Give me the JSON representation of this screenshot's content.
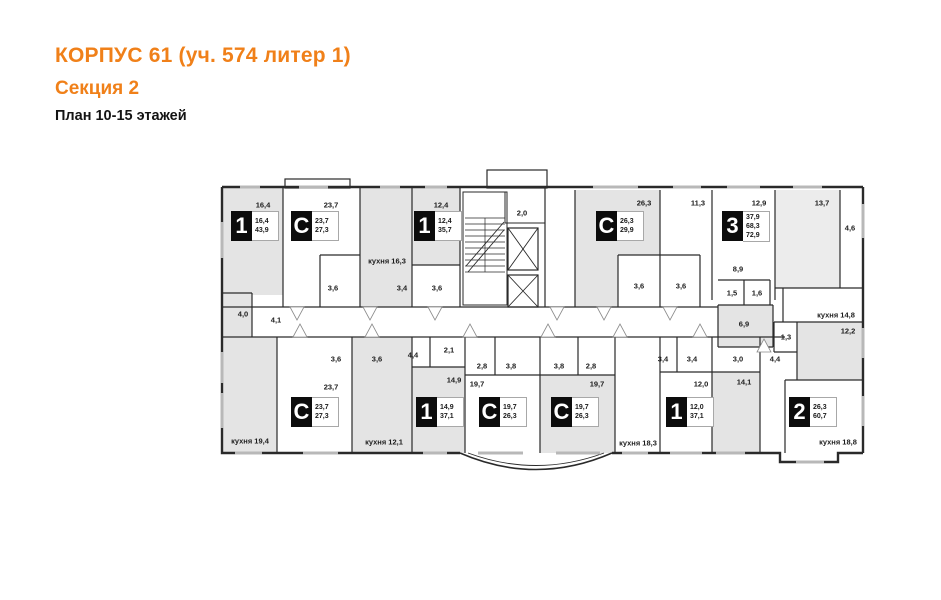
{
  "header": {
    "title": "КОРПУС 61 (уч. 574 литер 1)",
    "subtitle": "Секция 2",
    "plan_label": "План 10-15 этажей"
  },
  "colors": {
    "accent": "#f08019",
    "room_fill": "#e4e4e4",
    "wall": "#2a2a2a"
  },
  "plan": {
    "apartments": [
      {
        "type": "1",
        "areas": [
          "16,4",
          "43,9"
        ]
      },
      {
        "type": "С",
        "areas": [
          "23,7",
          "27,3"
        ]
      },
      {
        "type": "1",
        "areas": [
          "12,4",
          "35,7"
        ]
      },
      {
        "type": "С",
        "areas": [
          "26,3",
          "29,9"
        ]
      },
      {
        "type": "3",
        "areas": [
          "37,9",
          "68,3",
          "72,9"
        ]
      },
      {
        "type": "С",
        "areas": [
          "23,7",
          "27,3"
        ]
      },
      {
        "type": "1",
        "areas": [
          "14,9",
          "37,1"
        ]
      },
      {
        "type": "С",
        "areas": [
          "19,7",
          "26,3"
        ]
      },
      {
        "type": "С",
        "areas": [
          "19,7",
          "26,3"
        ]
      },
      {
        "type": "1",
        "areas": [
          "12,0",
          "37,1"
        ]
      },
      {
        "type": "2",
        "areas": [
          "26,3",
          "60,7"
        ]
      }
    ],
    "rooms": [
      "16,4",
      "23,7",
      "кухня 16,3",
      "3,6",
      "3,4",
      "12,4",
      "3,6",
      "2,0",
      "26,3",
      "3,6",
      "3,6",
      "11,3",
      "12,9",
      "13,7",
      "4,6",
      "8,9",
      "1,5",
      "1,6",
      "кухня 14,8",
      "6,9",
      "12,2",
      "1,3",
      "4,0",
      "4,1",
      "кухня 19,4",
      "3,6",
      "3,6",
      "23,7",
      "кухня 12,1",
      "4,4",
      "2,1",
      "14,9",
      "2,8",
      "19,7",
      "3,8",
      "3,8",
      "2,8",
      "19,7",
      "3,4",
      "3,4",
      "12,0",
      "кухня 18,3",
      "3,0",
      "14,1",
      "4,4",
      "кухня 18,8"
    ]
  }
}
